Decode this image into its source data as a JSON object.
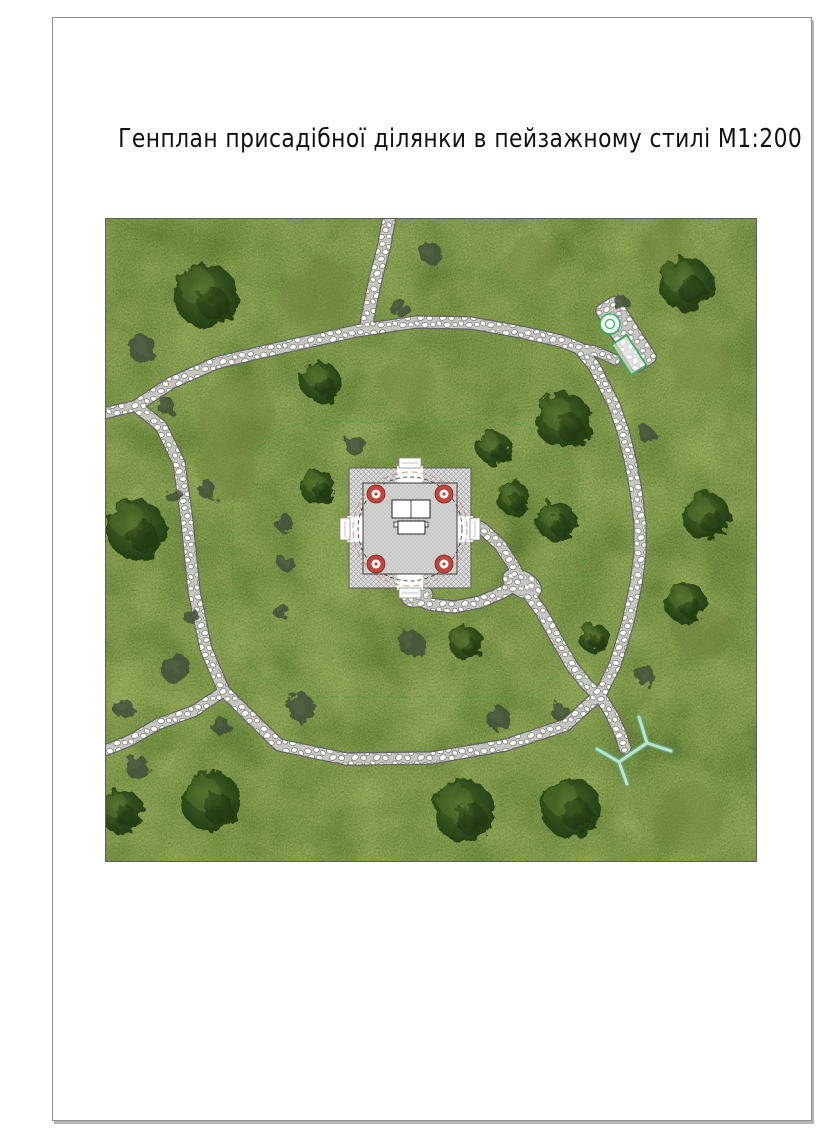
{
  "page": {
    "title": "Генплан присадібної ділянки в пейзажному стилі М1:200"
  },
  "plan": {
    "size": {
      "w": 650,
      "h": 642
    },
    "colors": {
      "page_border": "#8f8f8f",
      "title_color": "#111111",
      "grass_base": "#7f9b4b",
      "grass_dark": "#5b7a31",
      "grass_light": "#acbd68",
      "path_stone": "#fbfbf9",
      "path_gap": "#c6c6c0",
      "path_edge": "#636363",
      "column_red": "#c0453c",
      "axis_salmon": "#d4826a",
      "landscape_green": "#3cab63",
      "bed_dash": "#379a44",
      "branch_mint": "#b9e6c9",
      "branch_edge": "#69a583"
    },
    "bed_outline": {
      "x": 127,
      "y": 203,
      "w": 351,
      "h": 275,
      "rx": 85
    },
    "walkways": [
      {
        "name": "perimeter-loop",
        "width": 11,
        "closed": true,
        "points": [
          [
            30,
            187
          ],
          [
            65,
            164
          ],
          [
            110,
            144
          ],
          [
            160,
            132
          ],
          [
            205,
            122
          ],
          [
            250,
            112
          ],
          [
            310,
            103
          ],
          [
            365,
            104
          ],
          [
            415,
            113
          ],
          [
            455,
            122
          ],
          [
            473,
            129
          ],
          [
            488,
            147
          ],
          [
            498,
            166
          ],
          [
            508,
            186
          ],
          [
            517,
            212
          ],
          [
            524,
            240
          ],
          [
            530,
            272
          ],
          [
            534,
            305
          ],
          [
            534,
            335
          ],
          [
            530,
            365
          ],
          [
            522,
            403
          ],
          [
            509,
            446
          ],
          [
            495,
            474
          ],
          [
            460,
            506
          ],
          [
            400,
            526
          ],
          [
            325,
            539
          ],
          [
            240,
            540
          ],
          [
            173,
            526
          ],
          [
            118,
            472
          ],
          [
            100,
            430
          ],
          [
            88,
            372
          ],
          [
            81,
            302
          ],
          [
            73,
            244
          ],
          [
            55,
            207
          ]
        ]
      },
      {
        "name": "north-entry-path",
        "width": 12,
        "closed": false,
        "points": [
          [
            283,
            0
          ],
          [
            278,
            28
          ],
          [
            270,
            58
          ],
          [
            264,
            86
          ],
          [
            261,
            103
          ]
        ]
      },
      {
        "name": "west-exit-upper",
        "width": 10,
        "closed": false,
        "points": [
          [
            33,
            186
          ],
          [
            16,
            190
          ],
          [
            0,
            194
          ]
        ]
      },
      {
        "name": "west-exit-lower",
        "width": 10,
        "closed": false,
        "points": [
          [
            118,
            472
          ],
          [
            88,
            492
          ],
          [
            52,
            505
          ],
          [
            25,
            521
          ],
          [
            0,
            531
          ]
        ]
      },
      {
        "name": "seating-spur",
        "width": 9,
        "closed": false,
        "points": [
          [
            476,
            130
          ],
          [
            489,
            132
          ],
          [
            501,
            137
          ],
          [
            509,
            141
          ]
        ]
      },
      {
        "name": "gazebo-east-path",
        "width": 11,
        "closed": false,
        "points": [
          [
            362,
            302
          ],
          [
            377,
            310
          ],
          [
            394,
            326
          ],
          [
            407,
            346
          ],
          [
            414,
            360
          ]
        ]
      },
      {
        "name": "gazebo-south-path",
        "width": 11,
        "closed": false,
        "points": [
          [
            306,
            376
          ],
          [
            322,
            385
          ],
          [
            348,
            388
          ],
          [
            374,
            383
          ],
          [
            397,
            373
          ],
          [
            412,
            364
          ]
        ]
      },
      {
        "name": "southeast-branch",
        "width": 11,
        "closed": false,
        "points": [
          [
            420,
            372
          ],
          [
            435,
            392
          ],
          [
            450,
            419
          ],
          [
            466,
            447
          ],
          [
            481,
            466
          ],
          [
            496,
            480
          ],
          [
            506,
            496
          ],
          [
            514,
            514
          ],
          [
            519,
            529
          ]
        ]
      }
    ],
    "pads": [
      {
        "cx": 416,
        "cy": 365,
        "rx": 21,
        "ry": 13,
        "rot": 28
      },
      {
        "cx": 311,
        "cy": 377,
        "rx": 16,
        "ry": 11,
        "rot": -10
      }
    ],
    "gazebo": {
      "outer": {
        "x": 243,
        "y": 249,
        "w": 122,
        "h": 120
      },
      "floor": {
        "x": 257,
        "y": 264,
        "w": 94,
        "h": 91
      },
      "dashed_circle": {
        "cx": 304,
        "cy": 310,
        "r": 52
      },
      "axis_circle": {
        "cx": 304,
        "cy": 310,
        "r": 57
      },
      "columns": [
        [
          270,
          275
        ],
        [
          338,
          275
        ],
        [
          270,
          345
        ],
        [
          338,
          345
        ]
      ],
      "column_r": {
        "outer": 9,
        "inner": 4.5,
        "dot": 1.6
      },
      "entrances": {
        "top": {
          "gap": [
            291,
            247,
            26,
            19
          ],
          "apron": [
            293,
            239,
            22,
            10
          ]
        },
        "bottom": {
          "gap": [
            291,
            352,
            26,
            19
          ],
          "apron": [
            293,
            369,
            22,
            10
          ]
        },
        "left": {
          "gap": [
            241,
            297,
            18,
            26
          ],
          "apron": [
            234,
            299,
            10,
            22
          ]
        },
        "right": {
          "gap": [
            349,
            297,
            18,
            26
          ],
          "apron": [
            364,
            299,
            10,
            22
          ]
        }
      },
      "table": {
        "top": [
          286,
          281,
          38,
          18
        ],
        "divider_x": 305,
        "bench": [
          292,
          302,
          27,
          13
        ],
        "nubs": [
          [
            288,
            303,
            4,
            5
          ],
          [
            318,
            303,
            4,
            5
          ]
        ]
      }
    },
    "seating": {
      "pad": {
        "cx": 520,
        "cy": 115,
        "w": 28,
        "h": 78,
        "rot": -33
      },
      "fire_circle": {
        "cx": 504,
        "cy": 105,
        "r_outer": 10,
        "r_inner": 4.5
      },
      "table_rect": {
        "cx": 523,
        "cy": 136,
        "w": 36,
        "h": 18,
        "rot": 57
      }
    },
    "branch_symbol": {
      "segments": [
        [
          [
            491,
            530
          ],
          [
            513,
            543
          ]
        ],
        [
          [
            513,
            543
          ],
          [
            521,
            565
          ]
        ],
        [
          [
            513,
            543
          ],
          [
            541,
            524
          ]
        ],
        [
          [
            541,
            524
          ],
          [
            533,
            498
          ]
        ],
        [
          [
            541,
            524
          ],
          [
            565,
            532
          ]
        ]
      ]
    },
    "trees": {
      "dark": [
        [
          100,
          77,
          32
        ],
        [
          458,
          202,
          28
        ],
        [
          580,
          65,
          27
        ],
        [
          30,
          310,
          30
        ],
        [
          105,
          582,
          30
        ],
        [
          358,
          592,
          31
        ],
        [
          465,
          589,
          30
        ],
        [
          360,
          424,
          17
        ],
        [
          407,
          279,
          17
        ],
        [
          450,
          302,
          20
        ],
        [
          600,
          297,
          24
        ],
        [
          580,
          384,
          21
        ],
        [
          212,
          268,
          18
        ],
        [
          215,
          163,
          20
        ],
        [
          15,
          592,
          22
        ],
        [
          388,
          229,
          17
        ],
        [
          488,
          419,
          15
        ]
      ],
      "olive": [
        [
          213,
          77,
          37
        ],
        [
          302,
          163,
          26
        ],
        [
          130,
          197,
          40
        ],
        [
          582,
          599,
          35
        ],
        [
          595,
          142,
          30
        ],
        [
          428,
          42,
          25
        ],
        [
          560,
          30,
          28
        ],
        [
          120,
          252,
          30
        ],
        [
          595,
          412,
          28
        ]
      ],
      "bush": [
        [
          37,
          130,
          14
        ],
        [
          60,
          187,
          9
        ],
        [
          68,
          277,
          8
        ],
        [
          177,
          303,
          9
        ],
        [
          292,
          88,
          9
        ],
        [
          325,
          35,
          11
        ],
        [
          540,
          215,
          8
        ],
        [
          515,
          84,
          8
        ],
        [
          70,
          450,
          15
        ],
        [
          195,
          489,
          14
        ],
        [
          17,
          489,
          10
        ],
        [
          32,
          549,
          12
        ],
        [
          115,
          507,
          9
        ],
        [
          175,
          392,
          8
        ],
        [
          85,
          397,
          8
        ],
        [
          305,
          424,
          13
        ],
        [
          250,
          227,
          10
        ],
        [
          393,
          500,
          12
        ],
        [
          455,
          494,
          9
        ],
        [
          540,
          457,
          10
        ],
        [
          102,
          272,
          9
        ],
        [
          180,
          344,
          8
        ]
      ]
    }
  }
}
